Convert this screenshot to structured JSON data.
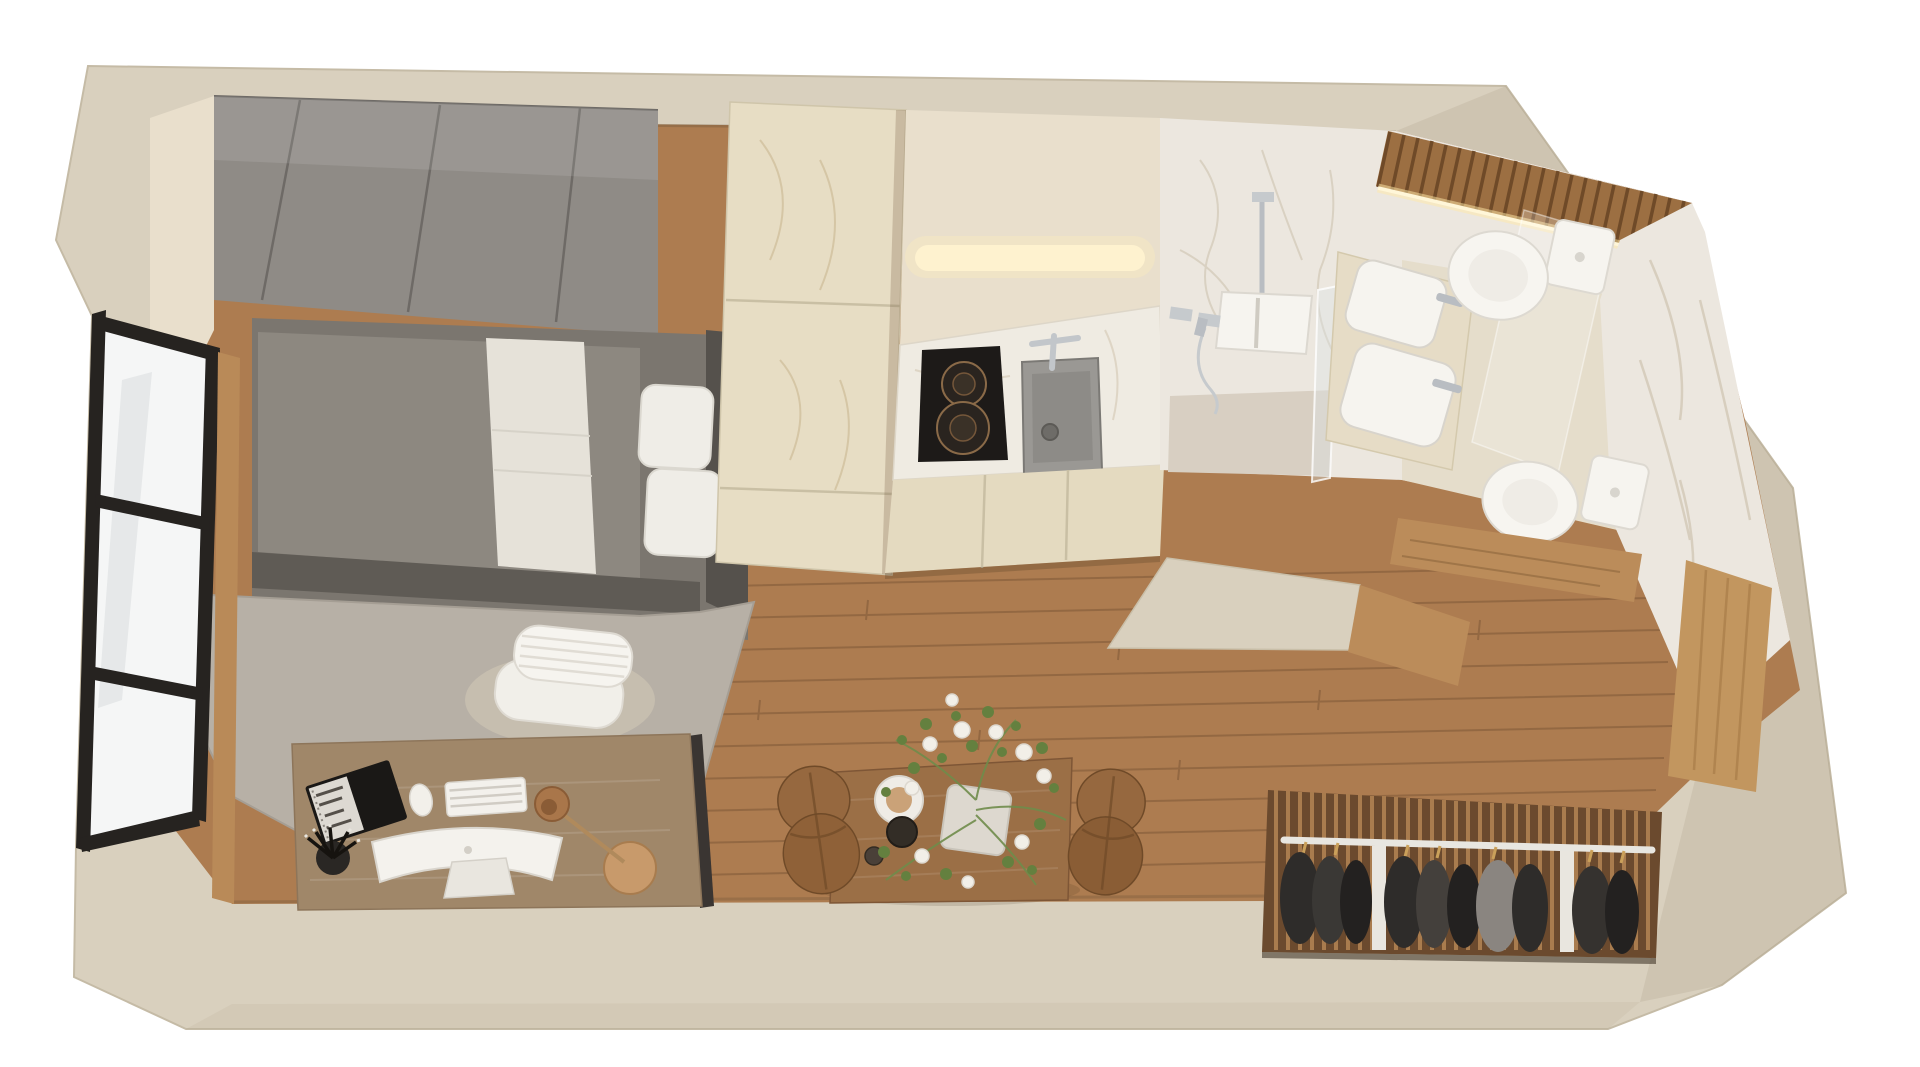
{
  "scene": {
    "type": "3d-floorplan-render",
    "description": "Top-down 3D render of a studio apartment with bedroom, kitchen, bathroom, dining nook and open closet",
    "rooms": [
      "bedroom",
      "kitchen",
      "bathroom",
      "dining-area",
      "dressing-area"
    ],
    "objects": [
      "wardrobe",
      "bed",
      "rug",
      "window",
      "desk",
      "computer",
      "keyboard",
      "mouse",
      "notebook",
      "pen-cup",
      "desk-lamp",
      "office-chair",
      "tall-cabinets",
      "cooktop",
      "kitchen-sink",
      "led-strip",
      "shower",
      "glass-screen",
      "vanity-basins",
      "toilet",
      "toilet-second",
      "mirror",
      "slat-ceiling",
      "dining-table",
      "flower-vase",
      "teapot",
      "dining-chairs",
      "closet-rail",
      "hanging-clothes",
      "wood-panels"
    ]
  },
  "colors": {
    "background": "#ffffff",
    "wall": "#d9d0be",
    "wallInner": "#e9dfcc",
    "floor": "#ad7c50",
    "rug": "#b7b0a6",
    "wardrobe": "#8f8b86",
    "bedPlatform": "#7b766f",
    "bedDuvet": "#8d8880",
    "bedSheet": "#e6e2d9",
    "bedFrame": "#5f5b55",
    "pillow": "#efede7",
    "cabinet": "#e7ddc4",
    "cabinetLow": "#e4dac0",
    "counter": "#efebe2",
    "cooktop": "#1d1a18",
    "sinkMetal": "#9a9894",
    "marble": "#ece7df",
    "slatWood": "#9c6f42",
    "ledGlow": "#fff3cf",
    "fixtureWhite": "#f6f4ef",
    "chrome": "#bfc3c8",
    "glass": "#f5f6f6",
    "deskWood": "#a08769",
    "chairWhite": "#f1efe9",
    "frameBlack": "#262320",
    "tableWood": "#9b6f46",
    "chairTan": "#96683f",
    "foliage": "#64803f",
    "blossom": "#f2efe8",
    "closetBack": "#6b4a2e",
    "closetSlat": "#a97c4e",
    "clothesDark": "#2e2c2a",
    "clothesGray": "#8a8580",
    "rail": "#e8e6e0",
    "panelWood": "#c2965f",
    "benchWood": "#bb8c5a",
    "lampBrass": "#c89a6b",
    "vanityCounter": "#e6dcc6",
    "bathFloor": "#e5ddcb",
    "showerFloor": "#d8cfc2"
  }
}
